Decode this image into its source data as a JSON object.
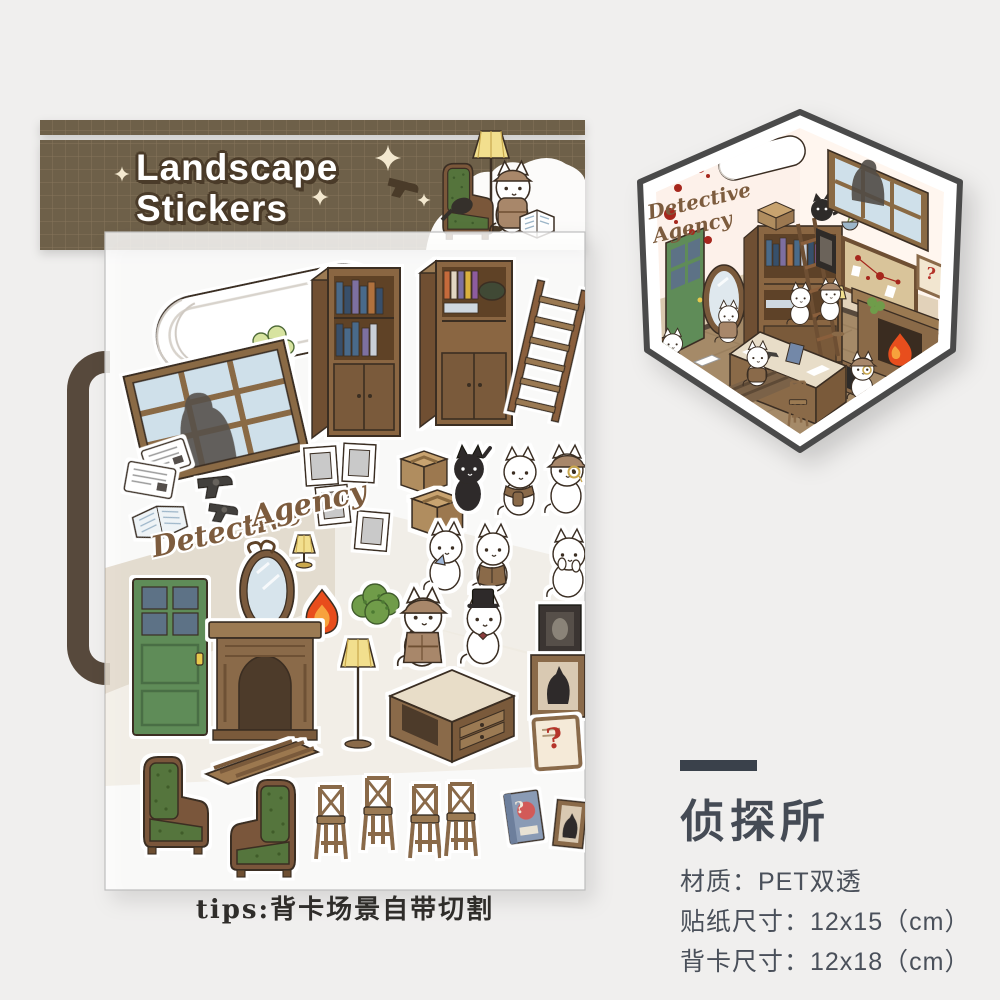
{
  "page": {
    "background": "#f0efee"
  },
  "banner": {
    "title_line1": "Landscape",
    "title_line2": "Stickers",
    "base_color": "#6e6049",
    "grid_color": "#8d7c60",
    "title_color": "#ffffff",
    "title_outline_color": "#4a3b29"
  },
  "sheet": {
    "script_word1": "Detective",
    "script_word2": "Agency",
    "stickers": [
      "air-conditioner",
      "potted-plant",
      "bookshelf-with-books",
      "bookshelf-with-cabinet",
      "ladder",
      "window-with-silhouette",
      "newspaper",
      "newspaper",
      "open-newspaper",
      "revolver",
      "revolver",
      "cardboard-box",
      "cardboard-box",
      "picture-frame",
      "picture-frame",
      "picture-frame",
      "picture-frame",
      "black-cat",
      "cat-with-scarf",
      "cat-with-monocle",
      "script-detective",
      "script-agency",
      "oval-mirror",
      "table-lamp",
      "flame",
      "bush",
      "cat-with-handkerchief",
      "cat-with-vest",
      "shy-cat",
      "green-door",
      "fireplace",
      "floor-lamp",
      "detective-cat",
      "cat-with-top-hat",
      "dark-portrait-frame",
      "black-cat-frame",
      "desk",
      "question-sign",
      "rug",
      "green-armchair",
      "green-armchair",
      "bar-stool",
      "bar-stool",
      "bar-stool",
      "bar-stool",
      "mystery-book",
      "tiny-cat-frame"
    ]
  },
  "hexagon": {
    "script_label": "Detective Agency",
    "elements": [
      "air-conditioner",
      "black-cat",
      "bookshelf",
      "ladder",
      "window-silhouette",
      "evidence-board",
      "green-door",
      "oval-mirror",
      "fireplace",
      "flame",
      "desk",
      "white-cats",
      "green-armchair",
      "blood-splatters",
      "floor-lamp",
      "question-sign"
    ]
  },
  "tips": {
    "text": "tips:背卡场景自带切割"
  },
  "product_info": {
    "heading": "侦探所",
    "material": "材质：PET双透",
    "sticker_size": "贴纸尺寸：12x15（cm）",
    "card_size": "背卡尺寸：12x18（cm）"
  },
  "misc": {
    "question_mark": "?",
    "sparkle": "✦"
  }
}
